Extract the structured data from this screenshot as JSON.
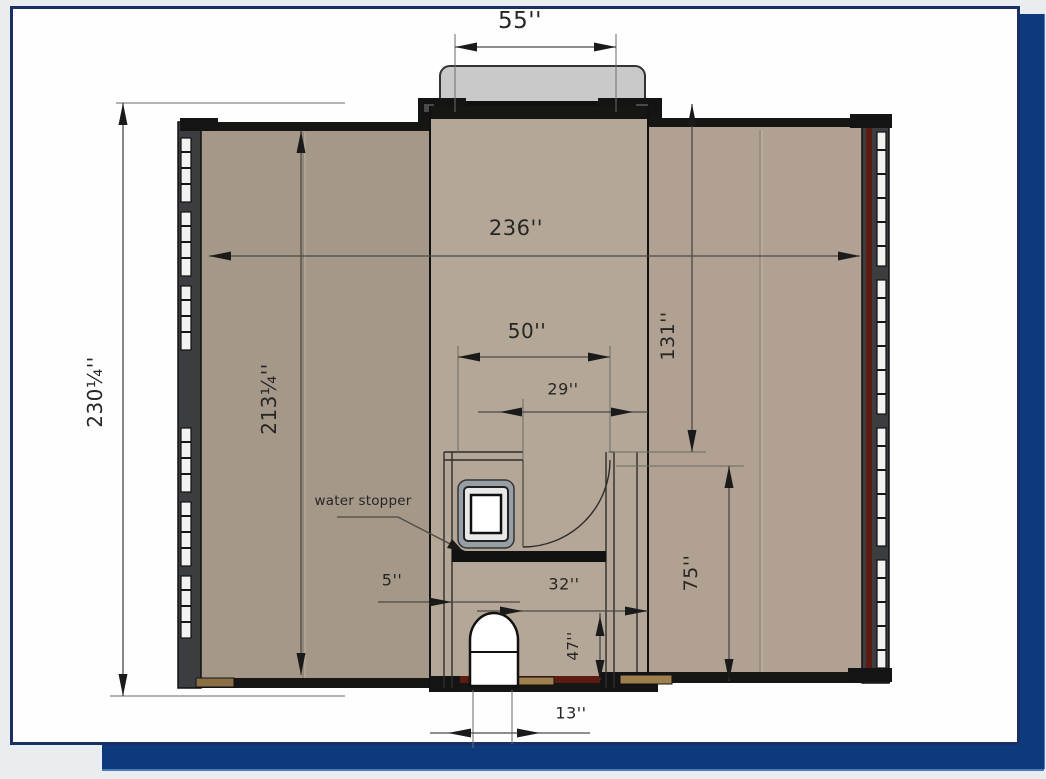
{
  "page": {
    "type": "floor-plan-drawing"
  },
  "colors": {
    "bg": "#e9edf0",
    "sheet": "#fefefe",
    "frame": "#1a2f63",
    "shadow": "#0d3a7c",
    "floor_left": "#a69889",
    "floor_center": "#b5a797",
    "floor_right": "#b0a192",
    "wall": "#3b3d40",
    "band": "#161614",
    "maroon": "#5e1b12",
    "landing": "#c9c9c9",
    "dim_line": "#4c4a45",
    "ink": "#262624"
  },
  "plan": {
    "annotation": {
      "water_stopper": "water stopper"
    },
    "dimensions": {
      "step_width": "55''",
      "overall_width": "236''",
      "overall_depth": "230¼''",
      "interior_depth": "213¼''",
      "bath_width": "50''",
      "door_opening": "29''",
      "right_depth_upper": "131''",
      "right_depth_lower": "75''",
      "wall_offset": "5''",
      "entry_width": "32''",
      "entry_depth": "47''",
      "entry_door_width": "13''"
    }
  }
}
